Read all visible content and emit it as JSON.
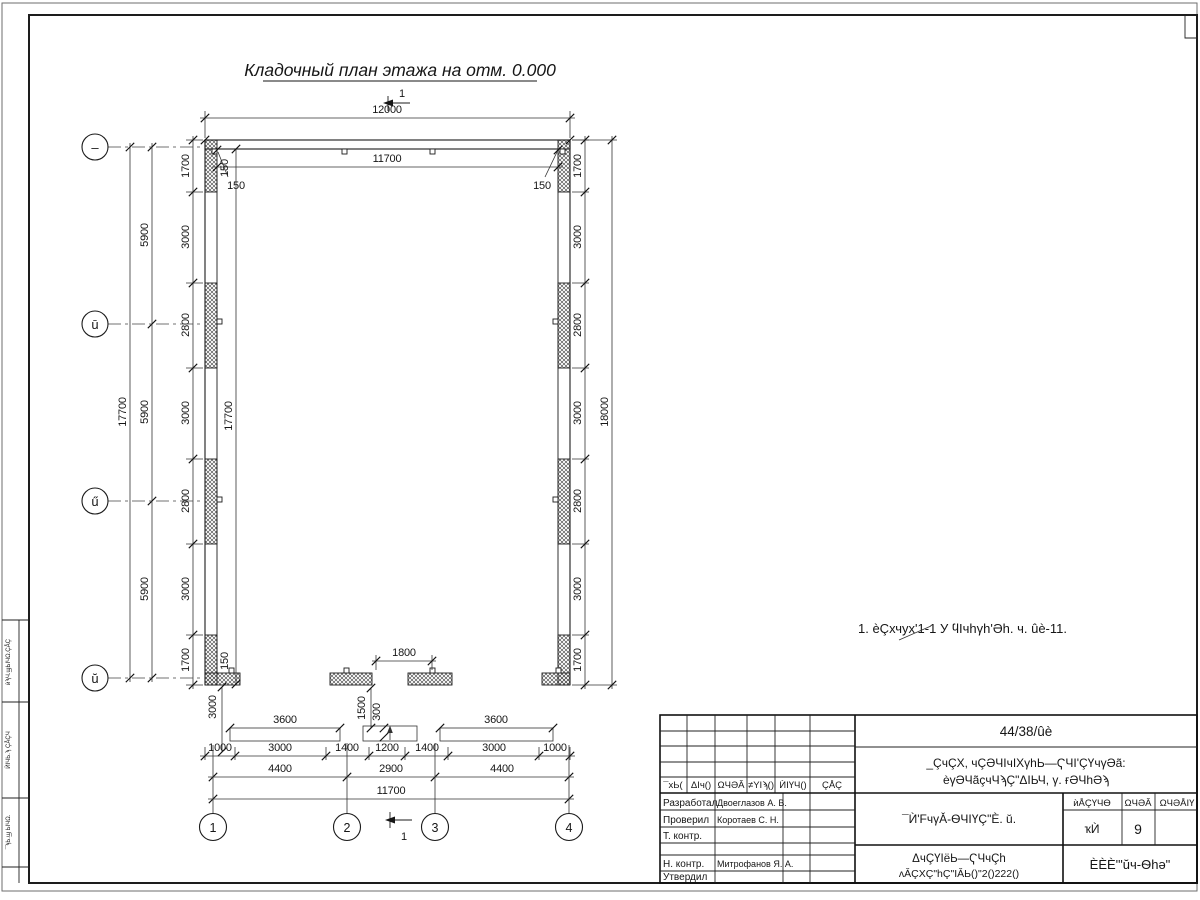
{
  "drawing": {
    "title": "Кладочный план этажа на отм. 0.000",
    "note": "1. èÇхчух'1-1 У ϥIчhγh'Əh. ч. ûè-11.",
    "section_label": "1"
  },
  "axes": {
    "left": [
      "–",
      "ū",
      "ű",
      "ŭ"
    ],
    "bottom": [
      "1",
      "2",
      "3",
      "4"
    ]
  },
  "dims": {
    "top_overall": "12000",
    "top_inner": "11700",
    "off_tl_v": "150",
    "off_tl": "150",
    "off_tr": "150",
    "off_bl": "150",
    "left_chain": [
      "1700",
      "3000",
      "2800",
      "3000",
      "2800",
      "3000",
      "1700"
    ],
    "left_axis": [
      "5900",
      "5900",
      "5900"
    ],
    "left_overall": "17700",
    "left_inner_overall": "17700",
    "right_chain": [
      "1700",
      "3000",
      "2800",
      "3000",
      "2800",
      "3000",
      "1700"
    ],
    "right_overall": "18000",
    "bot_opening": "1800",
    "bot_chain": [
      "1000",
      "3000",
      "1400",
      "1200",
      "1400",
      "3000",
      "1000"
    ],
    "bot_axis": [
      "4400",
      "2900",
      "4400"
    ],
    "bot_overall": "11700",
    "porch_left": "3600",
    "porch_right": "3600",
    "v_3000": "3000",
    "v_1500": "1500",
    "v_300": "300"
  },
  "titleblock": {
    "doc_number": "44/38/ûè",
    "project_line1": "_ÇчÇХ, чÇӘЧIчIХγhЬ—ҀЧI'ÇҮчγӘã:",
    "project_line2": "èγӘЧãçчЧϡÇ\"ΔIЬЧ, γ. ғӘЧhӘϡ",
    "drawing_title": "¯Ѝ'FчγǍ-ѲЧIҮÇ\"È. ŭ.",
    "header": [
      "¯хЬ(",
      "ΔIч()",
      "ΩЧӘĂ",
      "≠YIϡ()",
      "ЍIҮЧ()",
      "ÇÅÇ"
    ],
    "staff": [
      {
        "role": "Разработал",
        "name": "Двоеглазов А. В."
      },
      {
        "role": "Проверил",
        "name": "Коротаев С. Н."
      },
      {
        "role": "Т. контр.",
        "name": ""
      },
      {
        "role": "",
        "name": ""
      },
      {
        "role": "Н. контр.",
        "name": "Митрофанов Я. А."
      },
      {
        "role": "Утвердил",
        "name": ""
      }
    ],
    "stage_header": [
      "ѝÅÇҮЧѲ",
      "ΩЧӘĂ",
      "ΩЧӘÅIҮ"
    ],
    "stage_values": [
      "ҡЍ",
      "9",
      ""
    ],
    "org_line1": "ΔчÇҮIёЬ—ҀЧчÇh",
    "org_line2": "ʌǍÇХÇ\"hÇ\"IǍЬ()\"2()222()",
    "company": "ÈÈÈ'\"ŭч-Ѳhə\""
  },
  "side_strip": {
    "cells": [
      "ѝϡЧ.ϣЬIЧΩ.ÇÅÇ",
      "ЍIЧЬ.ϡ ÇÅÇЧ",
      "¯ϡЬ.ϣ ЬIЧΩ."
    ]
  }
}
